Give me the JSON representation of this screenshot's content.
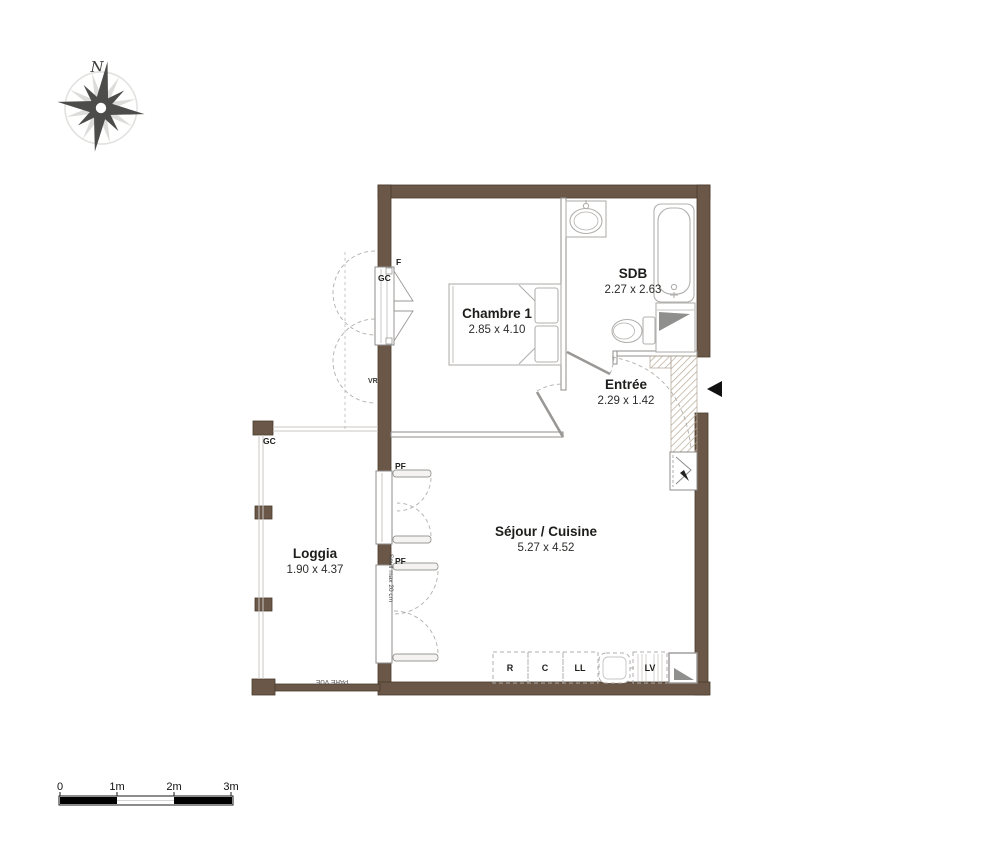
{
  "compass": {
    "north": "N"
  },
  "rooms": [
    {
      "name": "Chambre 1",
      "dims": "2.85 x 4.10"
    },
    {
      "name": "SDB",
      "dims": "2.27 x 2.63"
    },
    {
      "name": "Entrée",
      "dims": "2.29 x 1.42"
    },
    {
      "name": "Séjour / Cuisine",
      "dims": "5.27 x 4.52"
    },
    {
      "name": "Loggia",
      "dims": "1.90 x 4.37"
    }
  ],
  "labels": {
    "window_f": "F",
    "gc_chambre": "GC",
    "gc_loggia": "GC",
    "vr": "VR",
    "pf_upper": "PF",
    "pf_lower": "PF",
    "seuil": "Seuil max 20 cm",
    "pare_vue": "PARE VUE"
  },
  "kitchen": {
    "appliances": [
      "R",
      "C",
      "LL",
      "LV"
    ]
  },
  "scale_bar": {
    "ticks": [
      "0",
      "1m",
      "2m",
      "3m"
    ]
  },
  "colors": {
    "wall": "#6a5747",
    "wall_edge": "#4a3b2e",
    "partition_line": "#8f8d8b",
    "fixture_line": "#b2b0ae",
    "hatch": "#b7a893",
    "text": "#1d1d1b"
  }
}
